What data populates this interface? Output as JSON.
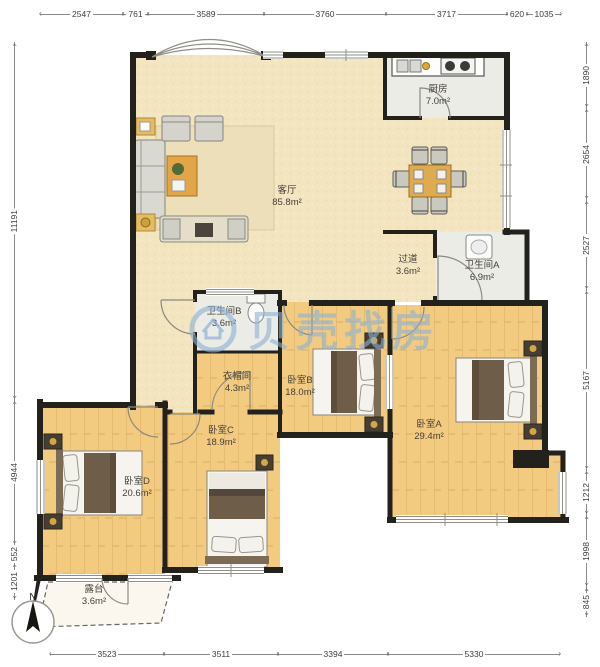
{
  "plan": {
    "watermark": "贝壳找房",
    "compass_label": "N"
  },
  "rooms": {
    "kitchen": {
      "name": "厨房",
      "area": "7.0m²"
    },
    "living_room": {
      "name": "客厅",
      "area": "85.8m²"
    },
    "hallway": {
      "name": "过道",
      "area": "3.6m²"
    },
    "bathroom_a": {
      "name": "卫生间A",
      "area": "6.9m²"
    },
    "bathroom_b": {
      "name": "卫生间B",
      "area": "3.6m²"
    },
    "closet": {
      "name": "衣帽间",
      "area": "4.3m²"
    },
    "bedroom_a": {
      "name": "卧室A",
      "area": "29.4m²"
    },
    "bedroom_b": {
      "name": "卧室B",
      "area": "18.0m²"
    },
    "bedroom_c": {
      "name": "卧室C",
      "area": "18.9m²"
    },
    "bedroom_d": {
      "name": "卧室D",
      "area": "20.6m²"
    },
    "terrace": {
      "name": "露台",
      "area": "3.6m²"
    }
  },
  "dimensions": {
    "top": [
      "2547",
      "761",
      "3589",
      "3760",
      "3717",
      "620",
      "1035"
    ],
    "right": [
      "1890",
      "2654",
      "2527",
      "5167",
      "1212",
      "1998",
      "845"
    ],
    "bottom": [
      "3523",
      "3511",
      "3394",
      "5330"
    ],
    "left": [
      "11191",
      "4944",
      "552",
      "1201"
    ]
  },
  "colors": {
    "wall": "#23211c",
    "wood_floor": "#f2cb80",
    "living_floor": "#f2e5bf",
    "tile_floor": "#ececE7",
    "watermark": "#8bb0d5"
  }
}
